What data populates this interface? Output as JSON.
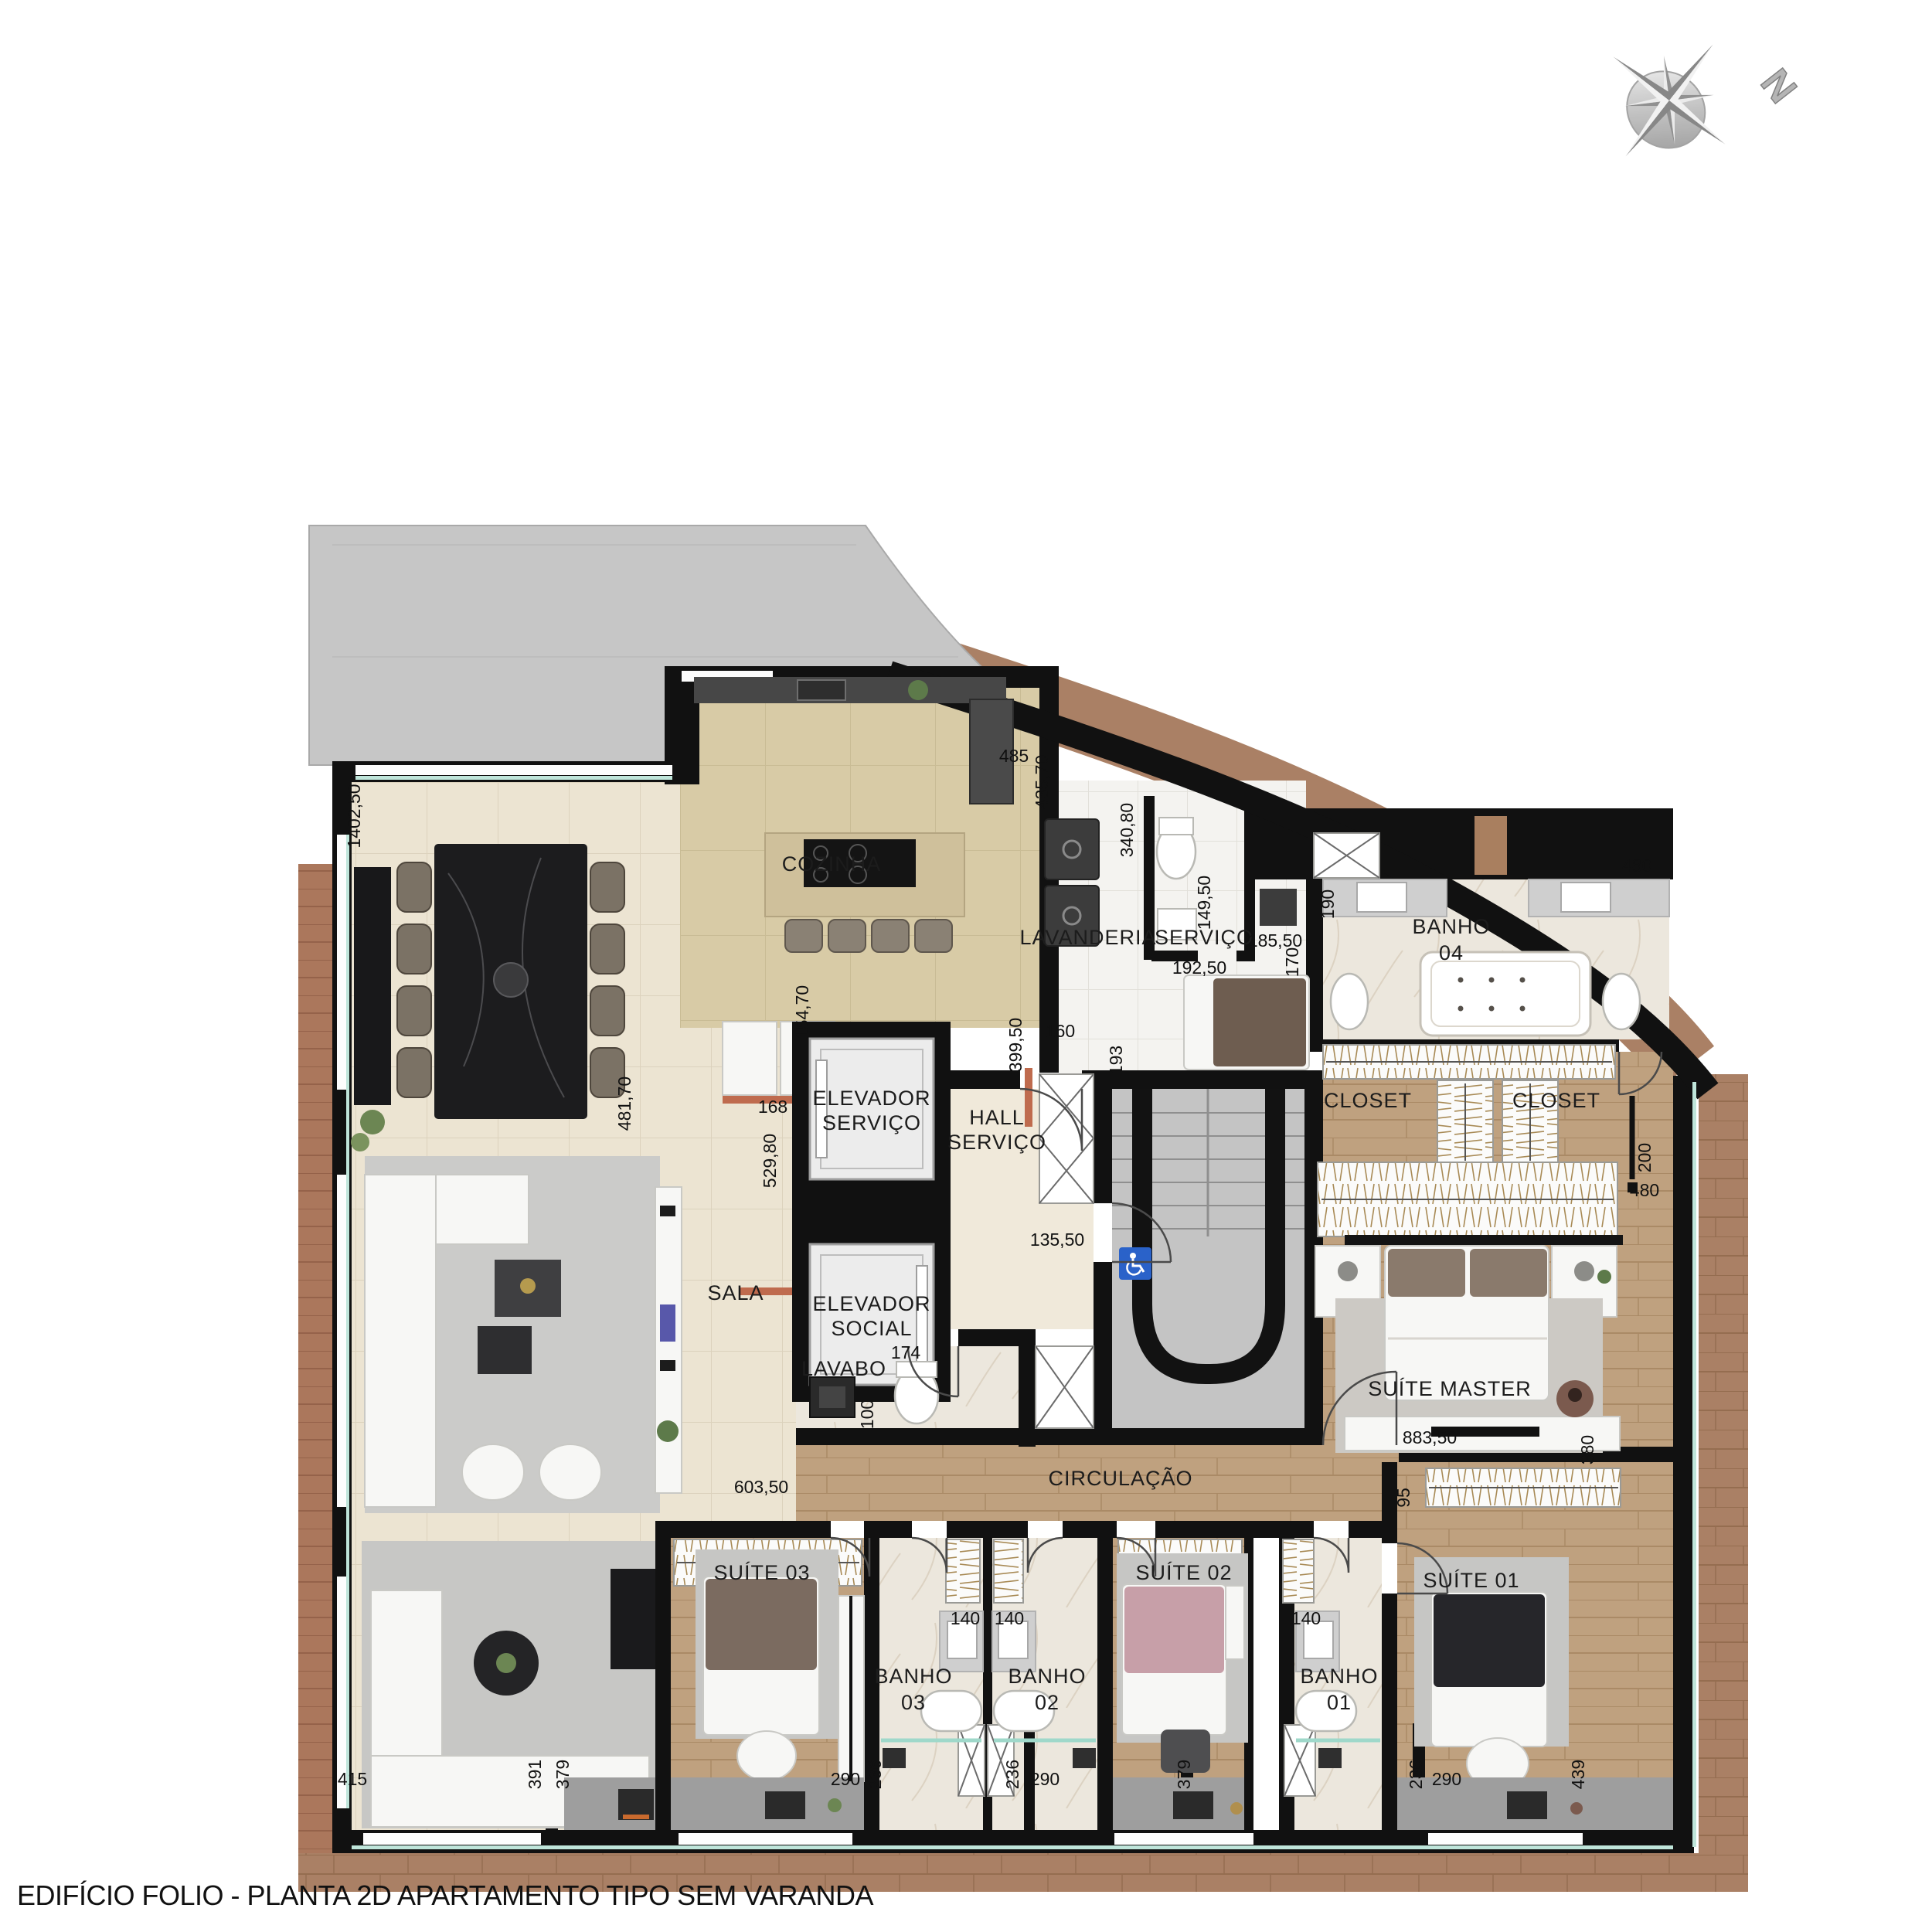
{
  "title": "EDIFÍCIO FOLIO - PLANTA 2D APARTAMENTO TIPO SEM VARANDA",
  "compass": {
    "north": "N"
  },
  "colors": {
    "wall": "#111111",
    "terrace": "#c6c6c6",
    "tile_living": "#ece4d2",
    "tile_kitchen": "#d8cba6",
    "tile_service": "#f4f3f0",
    "marble": "#ece7dd",
    "wood_floor": "#bfa17f",
    "deck_wood": "#aa8065",
    "glass": "#bfe5da",
    "accent_finish": "#bf6b4e",
    "accessibility_blue": "#2a62c9"
  },
  "rooms": {
    "cozinha": "COZINHA",
    "lavanderia": "LAVANDERIA",
    "servico": "SERVIÇO",
    "banho04_l1": "BANHO",
    "banho04_l2": "04",
    "closet_left": "CLOSET",
    "closet_right": "CLOSET",
    "elevador_servico_l1": "ELEVADOR",
    "elevador_servico_l2": "SERVIÇO",
    "hall_servico_l1": "HALL",
    "hall_servico_l2": "SERVIÇO",
    "elevador_social_l1": "ELEVADOR",
    "elevador_social_l2": "SOCIAL",
    "sala": "SALA",
    "lavabo": "LAVABO",
    "circulacao": "CIRCULAÇÃO",
    "suite_master": "SUÍTE MASTER",
    "suite03": "SUÍTE 03",
    "suite02": "SUÍTE 02",
    "suite01": "SUÍTE 01",
    "banho03_l1": "BANHO",
    "banho03_l2": "03",
    "banho02_l1": "BANHO",
    "banho02_l2": "02",
    "banho01_l1": "BANHO",
    "banho01_l2": "01"
  },
  "dims": {
    "terrace_left": "1402,50",
    "kitchen_top": "485",
    "kitchen_top_side": "435,70",
    "servico_wall": "340,80",
    "wc_servico_h": "149,50",
    "wc_servico_w": "192,50",
    "servico_w": "185,50",
    "servico_side": "170",
    "banho04_wall": "190",
    "banho04_top": "480",
    "entry_side": "154,70",
    "entry_w": "168",
    "sala_side": "481,70",
    "hall_entry": "529,80",
    "kitchen_pass": "399,50",
    "kitchen_door": "160",
    "hall_jamb": "193",
    "hall_w": "135,50",
    "lavabo_w": "174",
    "lavabo_h": "100",
    "sala_w": "603,50",
    "master_w": "883,50",
    "master_jamb": "95",
    "master_side": "380",
    "closet_side": "200",
    "closet_w": "480",
    "banho03_w": "140",
    "banho02_w": "140",
    "banho01_w": "140",
    "bottom_1": "415",
    "bottom_2": "391",
    "bottom_3": "379",
    "bottom_4": "290",
    "bottom_5": "236",
    "bottom_6": "236",
    "bottom_7": "290",
    "bottom_8": "379",
    "bottom_9": "236",
    "bottom_10": "290",
    "bottom_11": "439"
  }
}
